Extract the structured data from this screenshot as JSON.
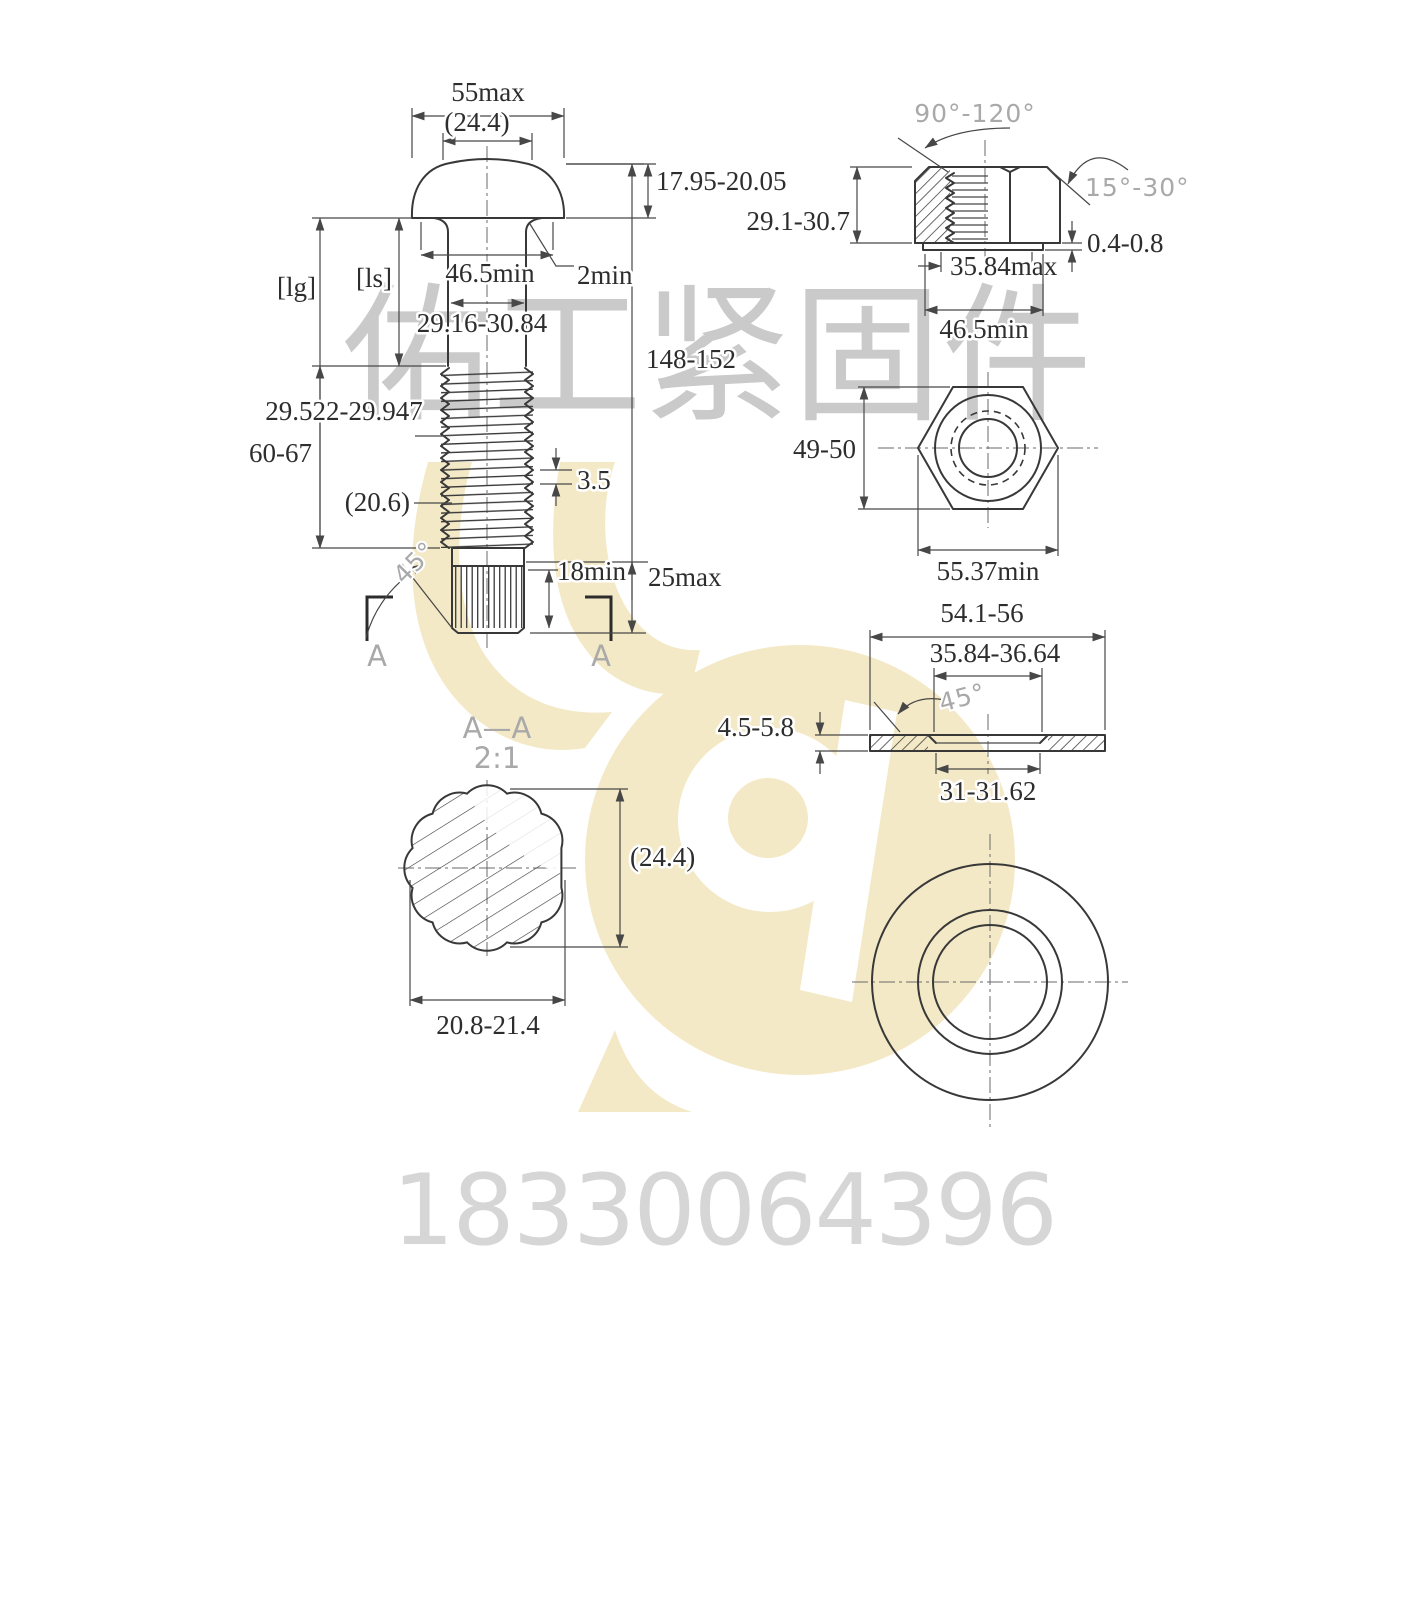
{
  "watermarks": {
    "company": "佑工紧固件",
    "phone": "18330064396",
    "logo_color": "#f4e9c6",
    "company_color": "#cacaca",
    "phone_color": "#d6d6d6"
  },
  "bolt_view": {
    "head_width_max": "55max",
    "head_ref_dia": "(24.4)",
    "head_height": "17.95-20.05",
    "grip_length_ref": "[lg]",
    "shank_length_ref": "[ls]",
    "bearing_dia_min": "46.5min",
    "underhead_fillet": "2min",
    "shank_dia": "29.16-30.84",
    "overall_length": "148-152",
    "thread_dia": "29.522-29.947",
    "thread_length": "60-67",
    "runout_ref": "(20.6)",
    "thread_pitch": "3.5",
    "point_chamfer_angle": "45°",
    "spline_length_min": "18min",
    "point_length_max": "25max",
    "section_mark_left": "A",
    "section_mark_right": "A"
  },
  "nut_view": {
    "countersink_angle": "90°-120°",
    "chamfer_angle": "15°-30°",
    "height": "29.1-30.7",
    "washer_face_height": "0.4-0.8",
    "washer_face_dia_max": "35.84max",
    "bearing_dia_min": "46.5min",
    "across_flats": "49-50",
    "across_corners_min": "55.37min"
  },
  "washer_view": {
    "outer_dia": "54.1-56",
    "face_dia": "35.84-36.64",
    "chamfer_angle": "45°",
    "thickness": "4.5-5.8",
    "hole_dia": "31-31.62"
  },
  "section_view": {
    "title": "A—A",
    "scale": "2:1",
    "height_ref": "(24.4)",
    "spline_dia": "20.8-21.4"
  }
}
